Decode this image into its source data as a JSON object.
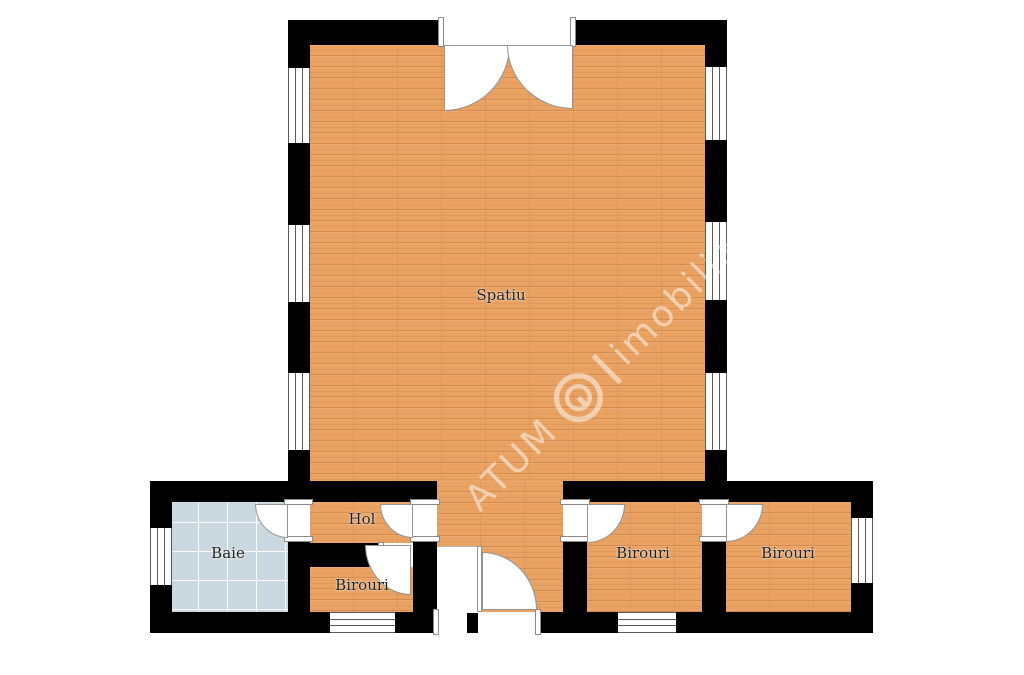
{
  "plan": {
    "rooms": {
      "spatiu": {
        "label": "Spatiu"
      },
      "baie": {
        "label": "Baie"
      },
      "hol": {
        "label": "Hol"
      },
      "birouri_left": {
        "label": "Birouri"
      },
      "birouri_middle": {
        "label": "Birouri"
      },
      "birouri_right": {
        "label": "Birouri"
      }
    },
    "watermark": {
      "brand": "ATUM",
      "company": "imobiliare"
    },
    "colors": {
      "wood_floor": "#eaa263",
      "tile_floor": "#cbd8e0",
      "wall": "#000000",
      "door_arc": "#949494",
      "background": "#ffffff"
    }
  }
}
